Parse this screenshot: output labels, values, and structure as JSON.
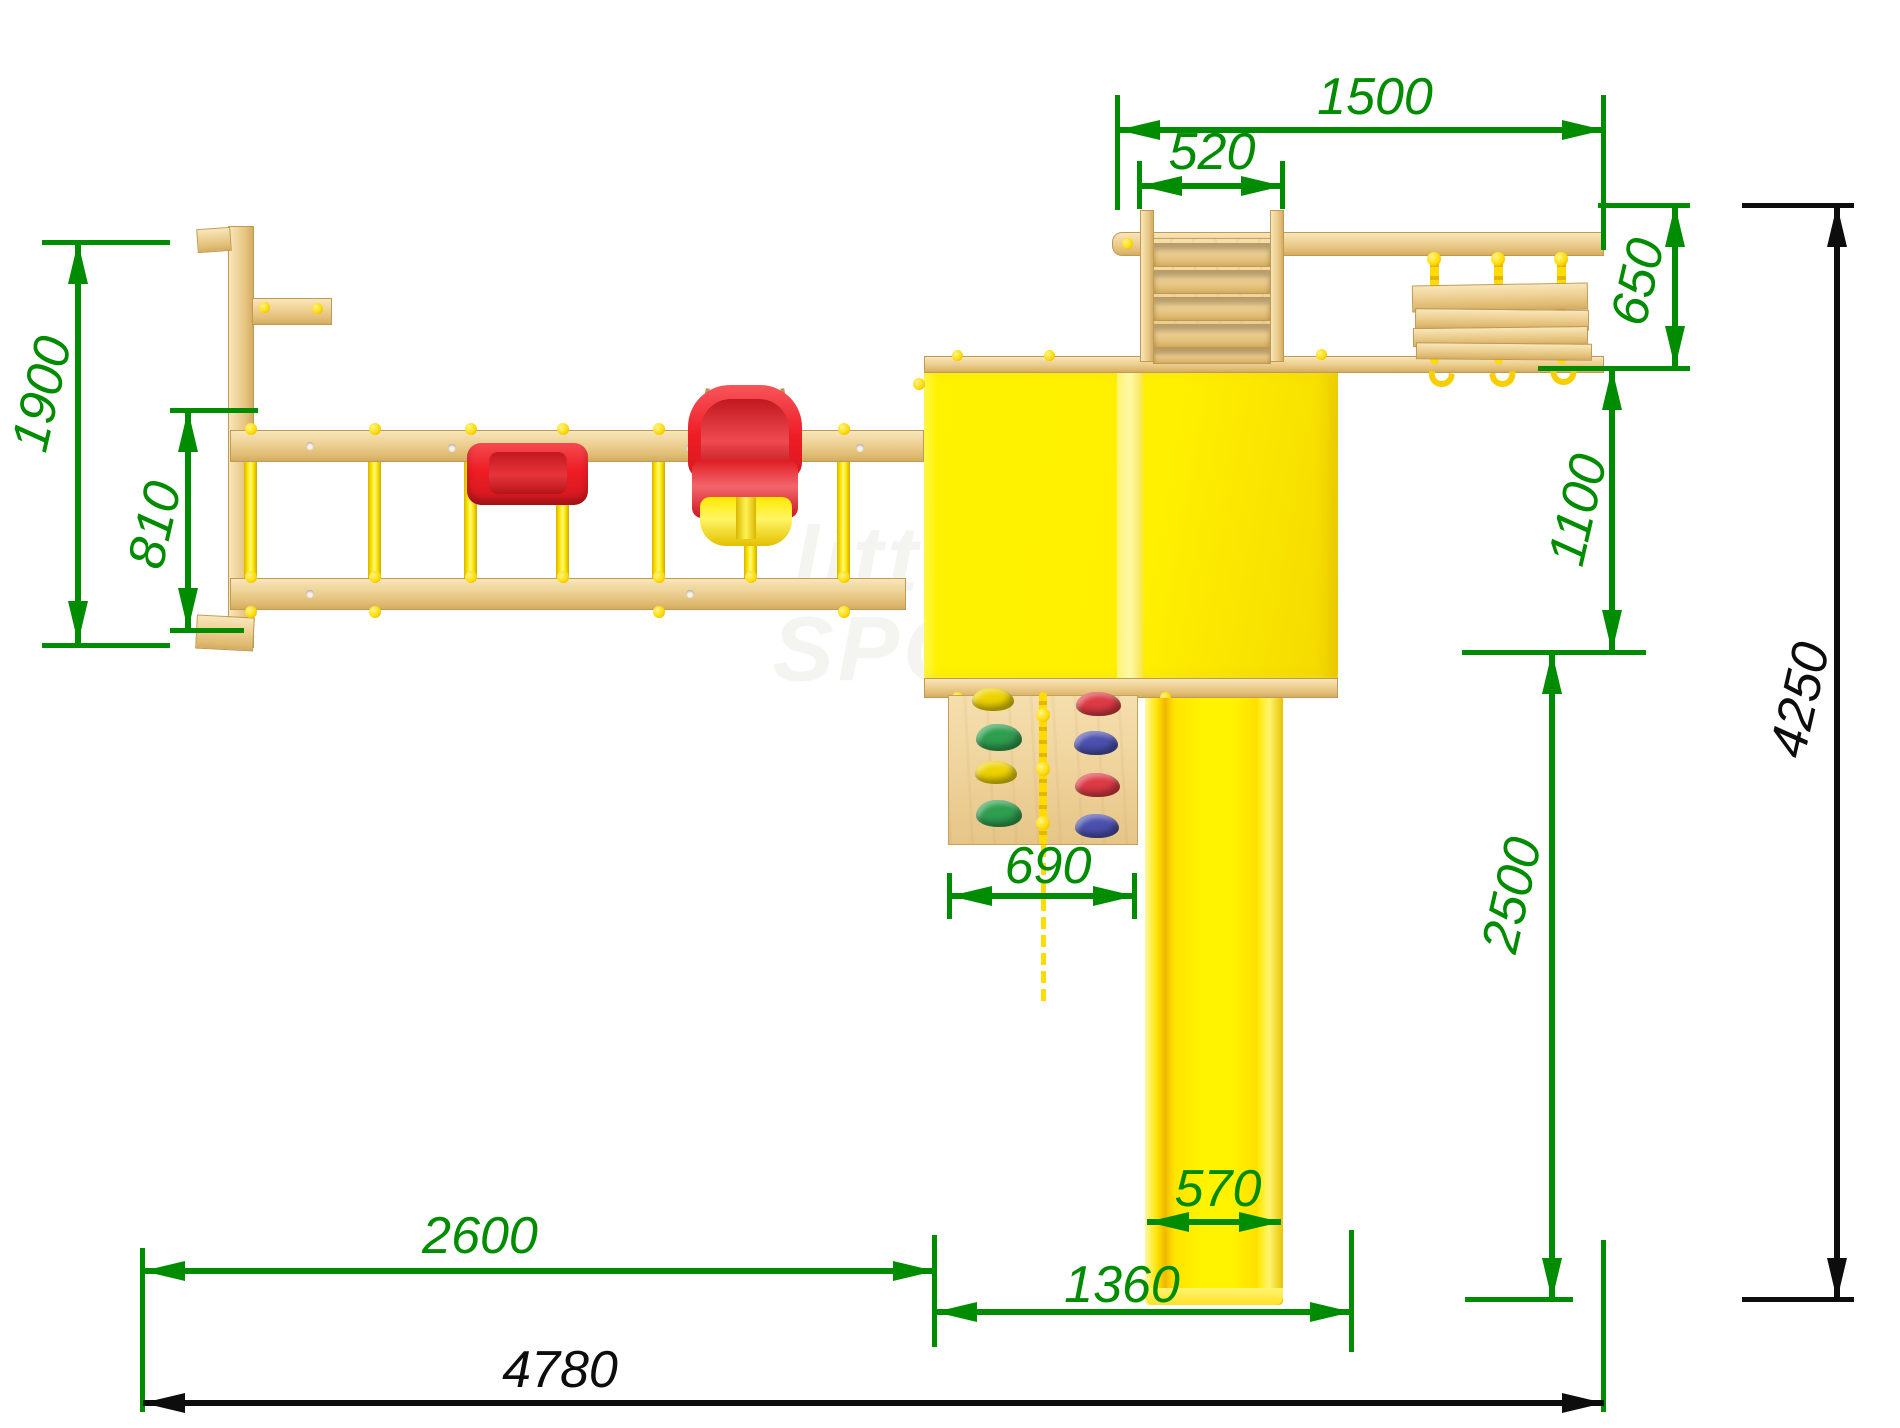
{
  "title": "playground-set-top-view-dimension-drawing",
  "dims": {
    "d1500": "1500",
    "d520": "520",
    "d650": "650",
    "d1100": "1100",
    "d4250": "4250",
    "d1900": "1900",
    "d810": "810",
    "d690": "690",
    "d2500": "2500",
    "d2600": "2600",
    "d1360": "1360",
    "d570": "570",
    "d4780": "4780"
  },
  "watermark": {
    "line1": "little",
    "line2": "SPORT"
  },
  "colors": {
    "dimension_green": "#008C00",
    "dimension_black": "#0d0d0d",
    "wood_light": "#f2d9a4",
    "wood_dark": "#d4ab60",
    "structure_yellow": "#fff000",
    "structure_yellow_light": "#fdf370",
    "seat_red": "#ee1c25",
    "seat_red_dark": "#c01920",
    "hold_green": "#2f9e4f",
    "hold_yellow": "#eed300",
    "hold_red": "#dd3a44",
    "hold_blue": "#4b50ae",
    "rope_yellow": "#f7cf00"
  }
}
